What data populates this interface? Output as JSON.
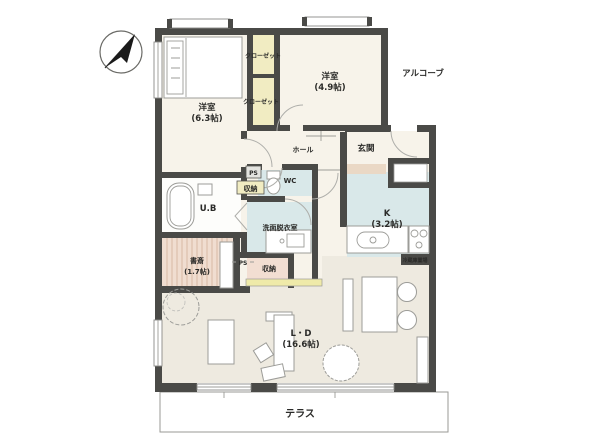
{
  "plan": {
    "title": "apartment-floor-plan",
    "compass": "north-arrow",
    "rooms": {
      "bedroom1": {
        "label": "洋室",
        "size": "(6.3帖)"
      },
      "bedroom2": {
        "label": "洋室",
        "size": "(4.9帖)"
      },
      "closet1": {
        "label": "クローゼット"
      },
      "closet2": {
        "label": "クローゼット"
      },
      "alcove": {
        "label": "アルコーブ"
      },
      "hall": {
        "label": "ホール"
      },
      "entrance": {
        "label": "玄関"
      },
      "wc": {
        "label": "WC"
      },
      "ub": {
        "label": "U.B"
      },
      "washroom": {
        "label": "洗面脱衣室"
      },
      "study": {
        "label": "書斎",
        "size": "(1.7帖)"
      },
      "kitchen": {
        "label": "K",
        "size": "(3.2帖)"
      },
      "ld": {
        "label": "L・D",
        "size": "(16.6帖)"
      },
      "terrace": {
        "label": "テラス"
      },
      "storage1": {
        "label": "収納"
      },
      "storage2": {
        "label": "収納"
      },
      "ps1": {
        "label": "PS"
      },
      "ps2": {
        "label": "PS"
      },
      "fridge": {
        "label": "冷蔵庫置場"
      }
    },
    "colors": {
      "wall": "#4a4a47",
      "floor_cream": "#f7f3ea",
      "floor_ld": "#eeeae0",
      "closet_yellow": "#f1ecc2",
      "wet_blue": "#d9e8e9",
      "study_pink": "#f0ddd0",
      "storage_pink": "#f2ded2",
      "step_beige": "#ead8c5"
    }
  }
}
